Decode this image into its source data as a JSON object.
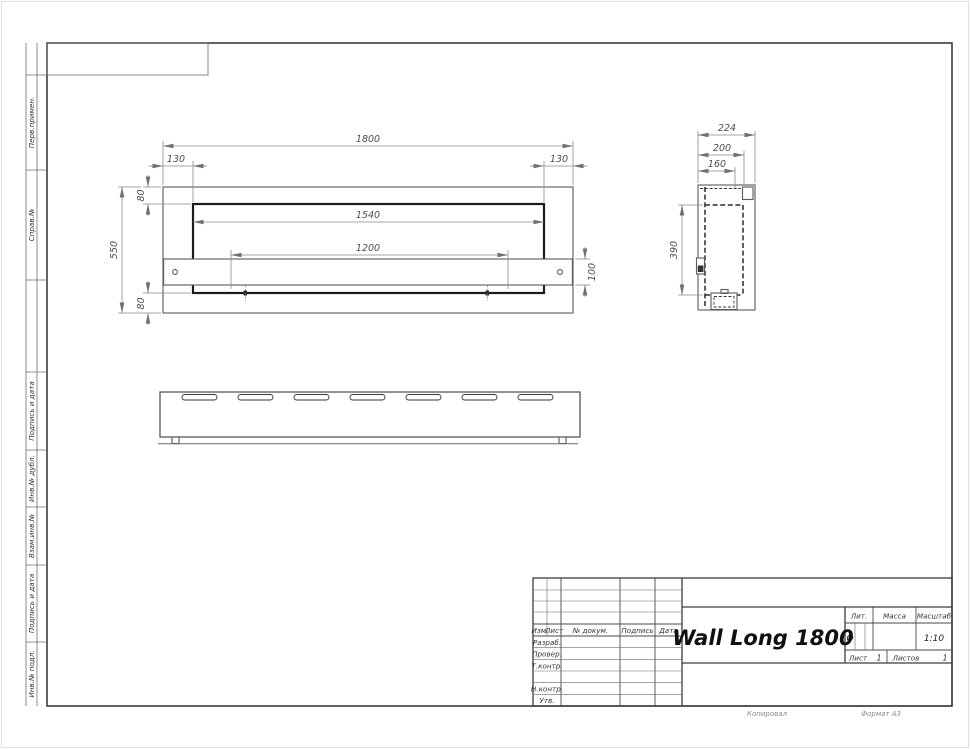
{
  "sheet": {
    "copied_label": "Копировал",
    "format_label": "Формат А3"
  },
  "margin": {
    "labels": [
      {
        "label": "Перв.примен."
      },
      {
        "label": "Справ.№"
      },
      {
        "label": "Подпись и дата"
      },
      {
        "label": "Инв.№ дубл."
      },
      {
        "label": "Взам.инв.№"
      },
      {
        "label": "Подпись и дата"
      },
      {
        "label": "Инв.№ подл."
      }
    ]
  },
  "views": {
    "front": {
      "dim_width": "1800",
      "dim_offset_left": "130",
      "dim_offset_right": "130",
      "dim_top": "80",
      "dim_height": "550",
      "dim_opening": "1540",
      "dim_burner": "1200",
      "dim_shelf": "100",
      "dim_bottom": "80"
    },
    "side": {
      "dim_depth": "224",
      "dim_inner": "200",
      "dim_bracket": "160",
      "dim_opening_height": "390"
    }
  },
  "title_block": {
    "title": "Wall Long 1800",
    "columns": {
      "izm": "Изм.",
      "list": "Лист",
      "doc": "№ докум.",
      "sign": "Подпись",
      "date": "Дата"
    },
    "rows": {
      "developed": "Разраб.",
      "checked": "Провер.",
      "tcontrol": "Т.контр.",
      "ncontrol": "Н.контр.",
      "approved": "Утв."
    },
    "lit_label": "Лит.",
    "lit_value": "О",
    "mass_label": "Масса",
    "scale_label": "Масштаб",
    "scale_value": "1:10",
    "sheet_label": "Лист",
    "sheet_value": "1",
    "sheets_label": "Листов",
    "sheets_value": "1"
  }
}
